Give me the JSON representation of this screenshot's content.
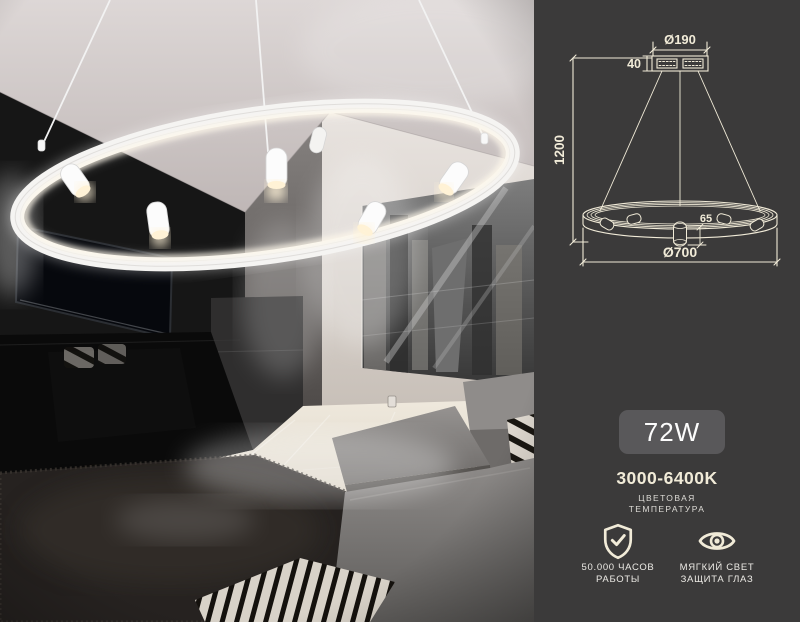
{
  "photo": {
    "alt": "Living room with a white LED ring pendant lamp with cylindrical spotlights, TV wall, black-and-white city poster, gray sofa, zebra throw and dark shag rug"
  },
  "panel": {
    "colors": {
      "background": "#3b3a3a",
      "line": "#f1ebd8",
      "badge_bg": "#59585a",
      "badge_text": "#fcfcfc",
      "label_text": "#dedcd7"
    },
    "diagram": {
      "canopy_diameter": "Ø190",
      "canopy_height": "40",
      "suspension_height": "1200",
      "spot_height": "65",
      "ring_diameter": "Ø700"
    },
    "specs": {
      "wattage": "72W",
      "color_temperature": "3000-6400K",
      "color_temperature_label": [
        "ЦВЕТОВАЯ",
        "ТЕМПЕРАТУРА"
      ],
      "features": [
        {
          "icon": "shield-check-icon",
          "lines": [
            "50.000 ЧАСОВ",
            "РАБОТЫ"
          ]
        },
        {
          "icon": "eye-icon",
          "lines": [
            "МЯГКИЙ СВЕТ",
            "ЗАЩИТА ГЛАЗ"
          ]
        }
      ]
    }
  }
}
